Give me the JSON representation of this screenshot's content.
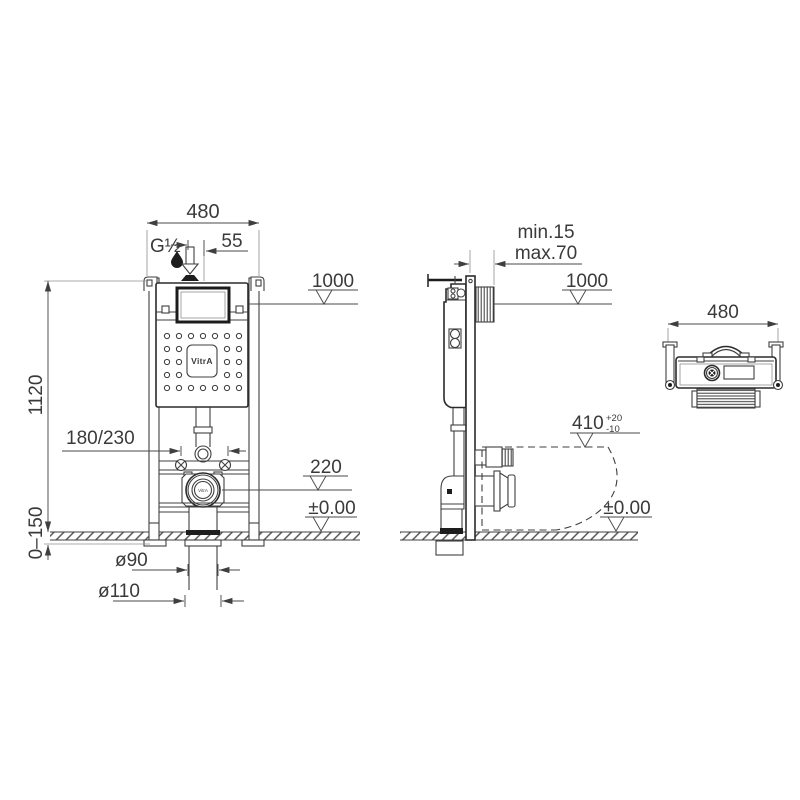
{
  "front_view": {
    "dim_width": "480",
    "supply": "G½",
    "dim_offset": "55",
    "level_top": "1000",
    "dim_height": "1120",
    "dim_outlet_range": "180/230",
    "level_outlet": "220",
    "level_floor": "±0.00",
    "dim_floor_range": "0–150",
    "dim_drain_inner": "ø90",
    "dim_drain_outer": "ø110",
    "brand": "VitrA",
    "outlet_brand": "VitrA"
  },
  "side_view": {
    "dim_wall_min": "min.15",
    "dim_wall_max": "max.70",
    "level_top": "1000",
    "dim_pan_depth": "410",
    "tol_plus": "+20",
    "tol_minus": "-10",
    "level_floor": "±0.00"
  },
  "top_view": {
    "dim_width": "480"
  }
}
